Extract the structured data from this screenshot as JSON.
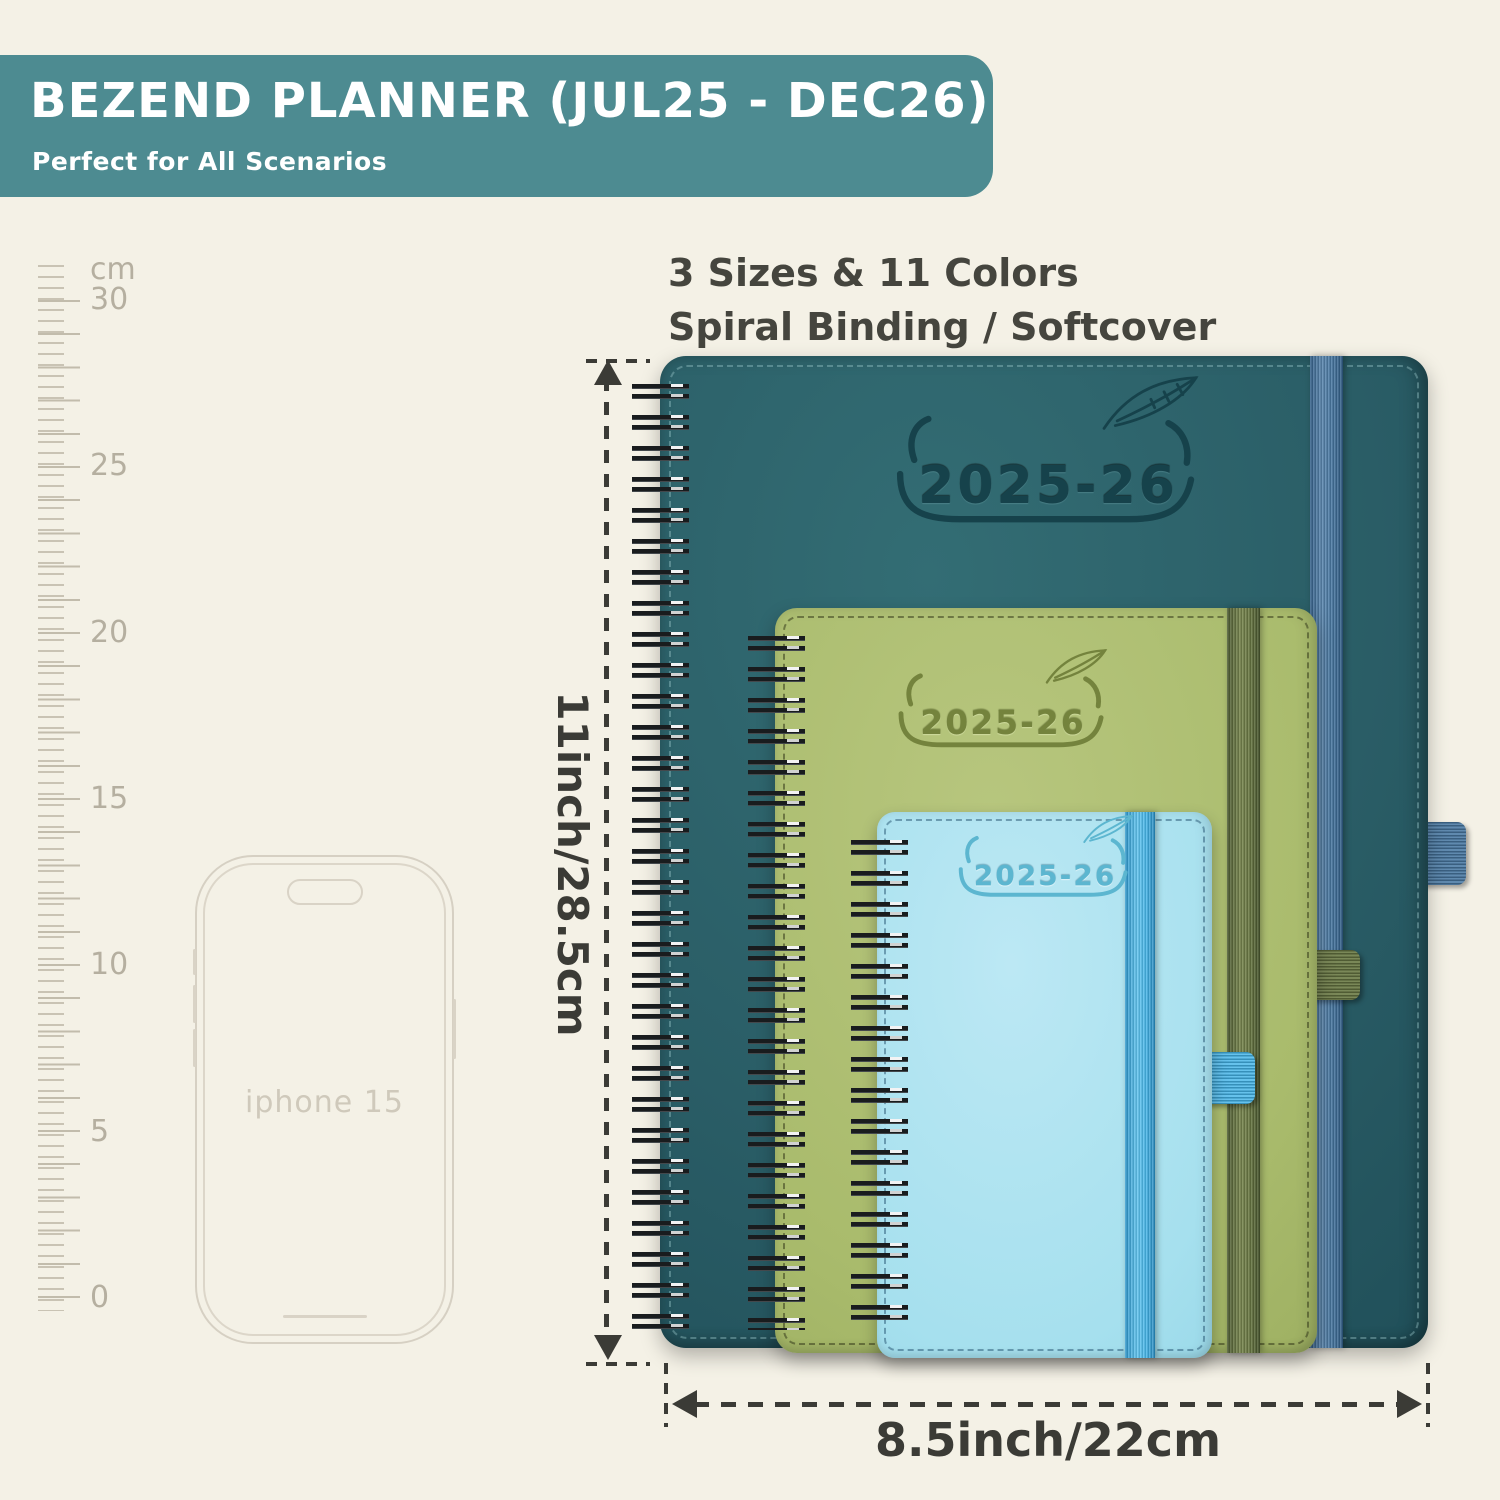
{
  "header": {
    "title": "BEZEND PLANNER (JUL25 - DEC26)",
    "subtitle": "Perfect for All Scenarios"
  },
  "features": {
    "line1": "3 Sizes & 11 Colors",
    "line2": "Spiral Binding / Softcover"
  },
  "ruler": {
    "unit": "cm",
    "labels": [
      "30",
      "25",
      "20",
      "15",
      "10",
      "5",
      "0"
    ]
  },
  "phone": {
    "label": "iphone 15"
  },
  "planners": {
    "large": {
      "year": "2025-26"
    },
    "medium": {
      "year": "2025-26"
    },
    "small": {
      "year": "2025-26"
    }
  },
  "dimensions": {
    "height_label": "11inch/28.5cm",
    "width_label": "8.5inch/22cm"
  },
  "colors": {
    "background": "#f4f1e6",
    "banner_teal": "#4d8b91",
    "planner_teal": "#2a5d66",
    "planner_green": "#a9bb6c",
    "planner_blue": "#a6e0ee",
    "elastic_steel_blue": "#4a7aa4",
    "elastic_olive": "#6b7a45",
    "elastic_bright_blue": "#46b6e9",
    "annotation": "#3b3b36"
  }
}
